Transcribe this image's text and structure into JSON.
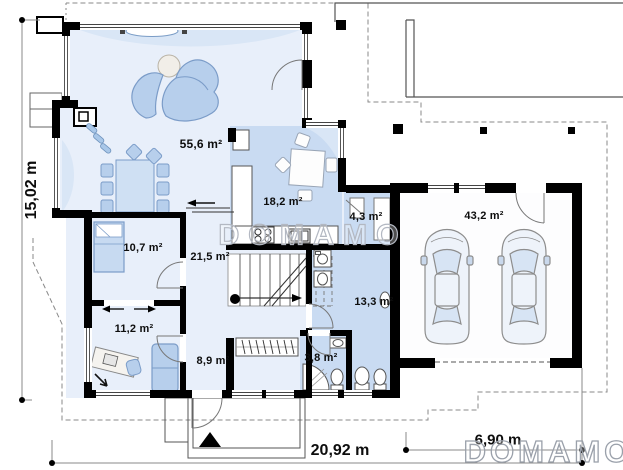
{
  "plan": {
    "rooms": [
      {
        "name": "living-room",
        "area": "55,6 m²"
      },
      {
        "name": "kitchen",
        "area": "18,2 m²"
      },
      {
        "name": "pantry",
        "area": "4,3 m²"
      },
      {
        "name": "garage",
        "area": "43,2 m²"
      },
      {
        "name": "bedroom",
        "area": "10,7 m²"
      },
      {
        "name": "hall",
        "area": "21,5 m²"
      },
      {
        "name": "office",
        "area": "11,2 m²"
      },
      {
        "name": "corridor",
        "area": "8,9 m²"
      },
      {
        "name": "bathroom",
        "area": "13,3 m²"
      },
      {
        "name": "wc",
        "area": "3,8 m²"
      }
    ],
    "dimensions": {
      "left_height": "15,02 m",
      "bottom_width": "20,92 m",
      "garage_width": "6,90 m"
    },
    "watermarks": {
      "center": "DOMAMO",
      "corner": "DOMAMO"
    },
    "colors": {
      "wall": "#000000",
      "room_light": "#e8effa",
      "room_dark": "#c9dbf2",
      "furniture": "#b7cfec",
      "watermark_outline": "#b3b8c2"
    }
  }
}
